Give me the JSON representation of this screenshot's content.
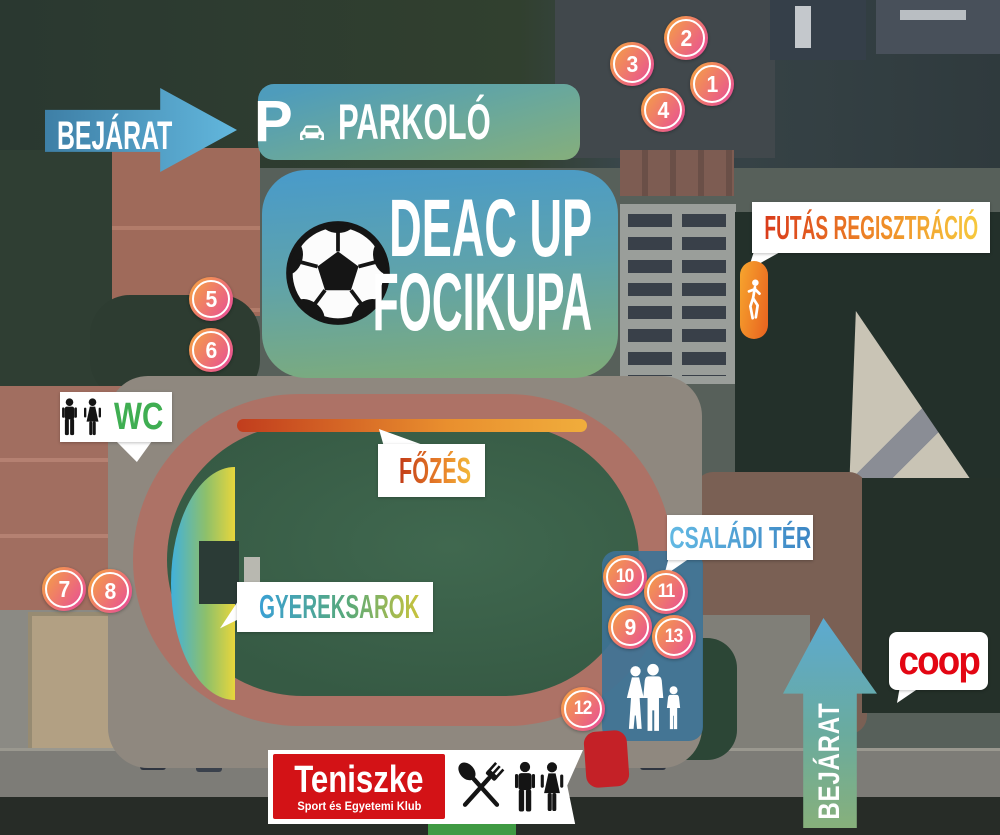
{
  "banners": {
    "entrance_top": {
      "label": "BEJÁRAT"
    },
    "parking": {
      "p": "P",
      "label": "PARKOLÓ"
    },
    "main": {
      "line1": "DEAC UP",
      "line2": "FOCIKUPA"
    },
    "run_registration": {
      "label": "FUTÁS REGISZTRÁCIÓ"
    },
    "wc": {
      "label": "WC"
    },
    "cooking": {
      "label": "FŐZÉS"
    },
    "family_area": {
      "label": "CSALÁDI TÉR"
    },
    "kids_corner": {
      "label": "GYEREKSAROK"
    },
    "entrance_bottom": {
      "label": "BEJÁRAT"
    }
  },
  "markers": [
    {
      "label": "1"
    },
    {
      "label": "2"
    },
    {
      "label": "3"
    },
    {
      "label": "4"
    },
    {
      "label": "5"
    },
    {
      "label": "6"
    },
    {
      "label": "7"
    },
    {
      "label": "8"
    },
    {
      "label": "9"
    },
    {
      "label": "10"
    },
    {
      "label": "11"
    },
    {
      "label": "12"
    },
    {
      "label": "13"
    }
  ],
  "sponsors": {
    "teniszke": {
      "name": "Teniszke",
      "subtitle": "Sport és Egyetemi Klub"
    },
    "coop": {
      "name": "coop"
    }
  },
  "icons": {
    "arrow_right": "entrance arrow pointing right",
    "arrow_up": "entrance arrow pointing up",
    "car": "car silhouette",
    "soccer_ball": "soccer ball",
    "runner": "running person",
    "man": "man pictogram",
    "woman": "woman pictogram",
    "flame": "flame",
    "playground": "climbing frame with rings",
    "family": "family walking silhouette",
    "cutlery": "crossed spoon and fork"
  },
  "colors": {
    "marker_gradient": [
      "#f5a144",
      "#e9558f"
    ],
    "main_banner_gradient": [
      "#4a9bc8",
      "#7dab7b"
    ],
    "entrance_arrow_blue": "#58aad2",
    "run_text_gradient": [
      "#d93a1a",
      "#f6c93e"
    ],
    "run_pill_orange": "#ef8c28",
    "wc_text_green": "#3fae52",
    "cooking_text_gradient": [
      "#c23b17",
      "#f2b93a"
    ],
    "family_label_blue": "#4aa0d4",
    "kids_text_gradient": [
      "#3aa0d4",
      "#58a97a",
      "#c9c33c"
    ],
    "family_panel_blue": "#3e7396",
    "teniszke_red": "#d31216",
    "coop_red": "#e30613",
    "stop_marker_red": "#c42127",
    "track_color": "#ad7266",
    "field_green": "#3a5e48"
  }
}
